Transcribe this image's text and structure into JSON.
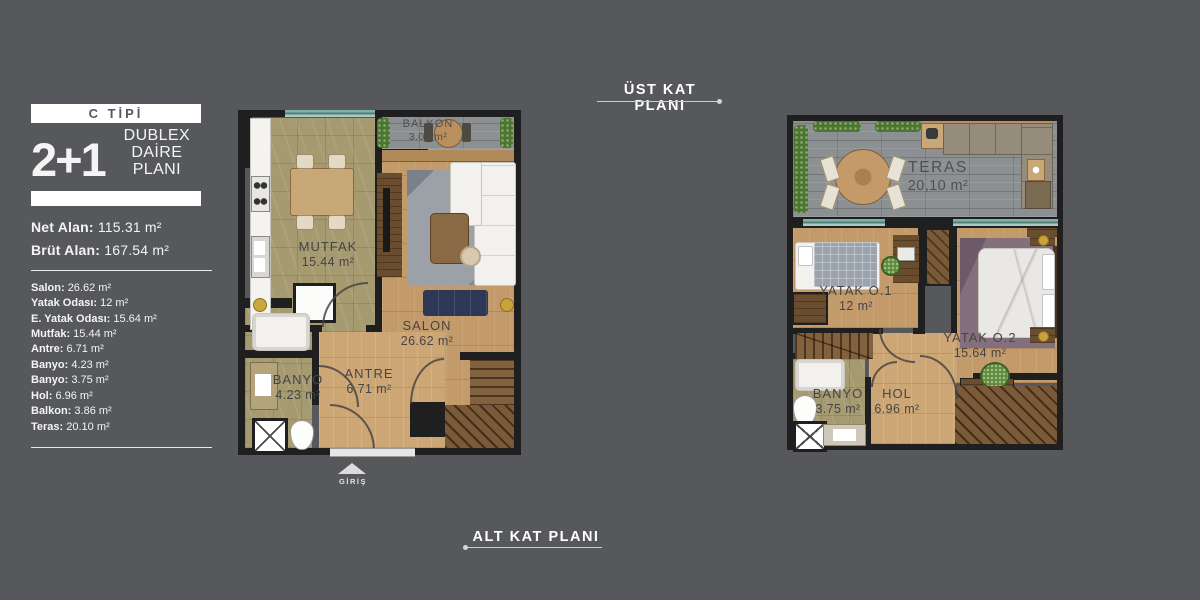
{
  "panel": {
    "type_label": "C TİPİ",
    "big_number": "2+1",
    "subtitle_line1": "DUBLEX",
    "subtitle_line2": "DAİRE PLANI",
    "net_label": "Net Alan:",
    "net_value": "115.31 m²",
    "brut_label": "Brüt Alan:",
    "brut_value": "167.54 m²",
    "rooms": [
      {
        "label": "Salon:",
        "value": "26.62 m²"
      },
      {
        "label": "Yatak Odası:",
        "value": "12 m²"
      },
      {
        "label": "E. Yatak Odası:",
        "value": "15.64 m²"
      },
      {
        "label": "Mutfak:",
        "value": "15.44 m²"
      },
      {
        "label": "Antre:",
        "value": "6.71 m²"
      },
      {
        "label": "Banyo:",
        "value": "4.23 m²"
      },
      {
        "label": "Banyo:",
        "value": "3.75 m²"
      },
      {
        "label": "Hol:",
        "value": "6.96 m²"
      },
      {
        "label": "Balkon:",
        "value": "3.86 m²"
      },
      {
        "label": "Teras:",
        "value": "20.10 m²"
      }
    ]
  },
  "labels": {
    "upper_plan": "ÜST KAT PLANI",
    "lower_plan": "ALT KAT PLANI",
    "entrance": "GİRİŞ"
  },
  "lower_plan": {
    "balkon": {
      "name": "BALKON",
      "area": "3.02 m²"
    },
    "mutfak": {
      "name": "MUTFAK",
      "area": "15.44 m²"
    },
    "salon": {
      "name": "SALON",
      "area": "26.62 m²"
    },
    "antre": {
      "name": "ANTRE",
      "area": "6.71 m²"
    },
    "banyo": {
      "name": "BANYO",
      "area": "4.23 m²"
    }
  },
  "upper_plan": {
    "teras": {
      "name": "TERAS",
      "area": "20,10 m²"
    },
    "yatak1": {
      "name": "YATAK O.1",
      "area": "12 m²"
    },
    "yatak2": {
      "name": "YATAK O.2",
      "area": "15.64 m²"
    },
    "banyo": {
      "name": "BANYO",
      "area": "3.75 m²"
    },
    "hol": {
      "name": "HOL",
      "area": "6.96 m²"
    }
  },
  "colors": {
    "background": "#56585c",
    "wall": "#1f1f1f",
    "window_glass": "#7fb2aa",
    "wood_floor": "#c39b6b",
    "tile_floor": "#a69a70",
    "deck": "#8d9093",
    "plan_text": "#454545",
    "panel_text": "#ffffff"
  }
}
